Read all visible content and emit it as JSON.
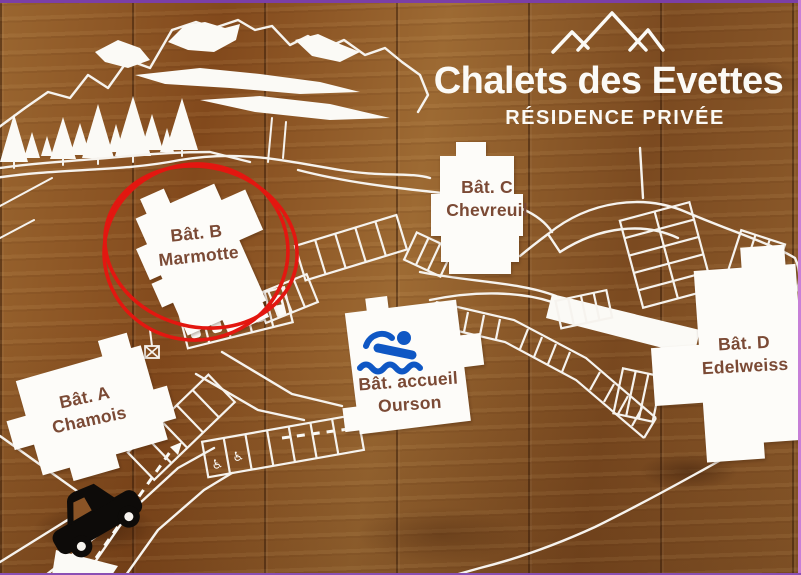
{
  "title": "Chalets des Evettes",
  "subtitle": "RÉSIDENCE PRIVÉE",
  "buildings": [
    {
      "line1": "Bât. A",
      "line2": "Chamois",
      "highlighted": false
    },
    {
      "line1": "Bât. B",
      "line2": "Marmotte",
      "highlighted": true
    },
    {
      "line1": "Bât. C",
      "line2": "Chevreuil",
      "highlighted": false
    },
    {
      "line1": "Bât. accueil",
      "line2": "Ourson",
      "highlighted": false
    },
    {
      "line1": "Bât. D",
      "line2": "Edelweiss",
      "highlighted": false
    }
  ],
  "icons": {
    "wheelchair": "♿",
    "swimmer": "swimmer-icon",
    "car": "car-icon",
    "mountain_logo": "mountain-peaks-icon",
    "mountain_range": "mountain-range-icon",
    "pine_trees": "pine-trees-icon"
  },
  "colors": {
    "highlight_circle": "#e31710",
    "swimmer_blue": "#0f57c4",
    "map_lines": "#f6f3ee",
    "label_text": "#7b4a35",
    "wood_base": "#8a5426",
    "frame_purple": "#8a4fb5"
  }
}
